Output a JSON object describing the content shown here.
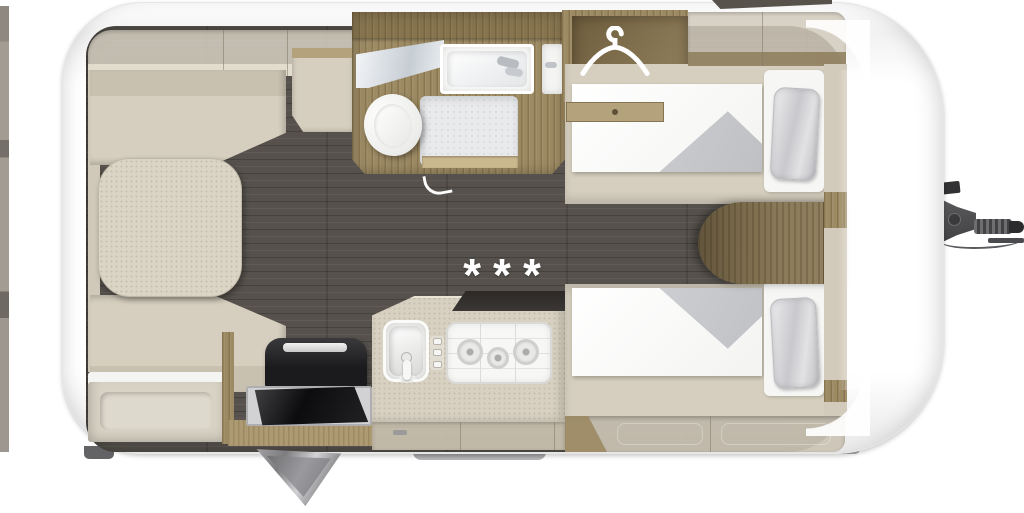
{
  "kitchen": {
    "hob_symbols": "***"
  },
  "icons": {
    "wardrobe": "hanger-icon",
    "bathroom": [
      "toilet",
      "shower-tray",
      "washbasin",
      "mirror"
    ],
    "kitchen": [
      "sink",
      "three-burner-hob",
      "control-knobs",
      "refrigerator"
    ],
    "exterior": [
      "tow-hitch",
      "entry-door-open",
      "entry-step"
    ]
  },
  "colors": {
    "body": "#ffffff",
    "floor_dark": "#56514c",
    "wood": "#9c8a63",
    "wood_dark": "#7d6b47",
    "wood_light": "#b3a27c",
    "upholstery": "#d6cfbf",
    "upholstery_dark": "#c8c1b0",
    "table": "#dbd5c6",
    "cabinet_translucent": "#d2cbbc",
    "bedding_white": "#fafafa",
    "bedding_fold": "#c7c8cc",
    "pillow": "#d7d7da",
    "appliance_black": "#1b1b1d",
    "counter_flap_dark": "#3b3734",
    "metal_gray": "#8f8f91",
    "hitch": "#4a4a4c",
    "symbol_white": "#ffffff"
  }
}
